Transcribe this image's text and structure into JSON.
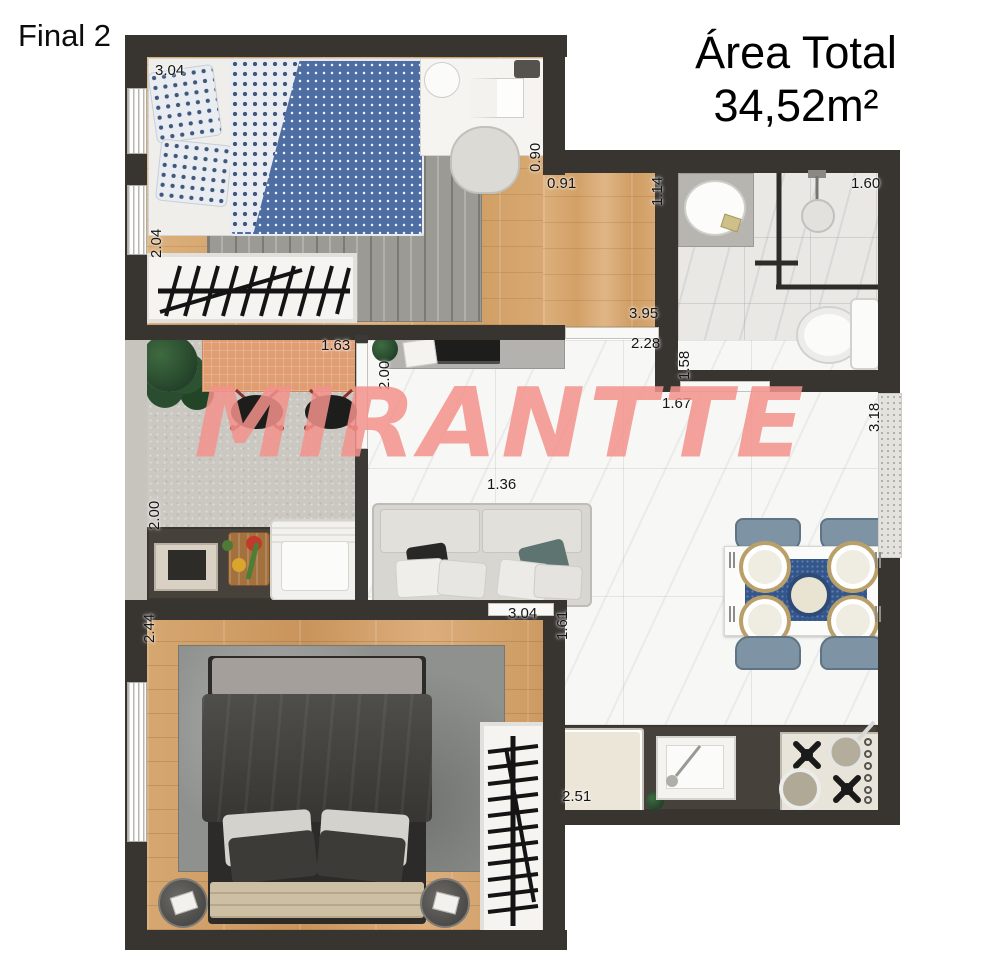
{
  "header": {
    "plan_label": "Final 2",
    "area_title": "Área Total",
    "area_value": "34,52m²"
  },
  "watermark": {
    "text": "MIRANTTE"
  },
  "colors": {
    "watermark_pink": "#f3928c",
    "wall_dark": "#383430",
    "wood_floor": "#d9ab76",
    "marble_floor": "#f7f7f5",
    "duvet_blue": "#4d6da3",
    "dining_runner_blue": "#33568c",
    "balcony_table_terracotta": "#e09d72"
  },
  "measurements": {
    "bed1_width": "3.04",
    "bed1_height": "2.04",
    "bed1_door": "0.90",
    "bed1_nook": "0.91",
    "hall_side": "1.14",
    "bath_width": "1.60",
    "bath_height": "1.58",
    "hall_width": "3.95",
    "hall_inner": "2.28",
    "bath_door": "1.67",
    "window_right": "3.18",
    "balcony_table": "1.63",
    "balcony_depth": "2.00",
    "service_depth": "2.00",
    "sofa_width": "1.36",
    "bed2_height": "2.44",
    "bed2_width": "3.04",
    "bed2_door": "1.61",
    "kitchen_width": "2.51"
  }
}
